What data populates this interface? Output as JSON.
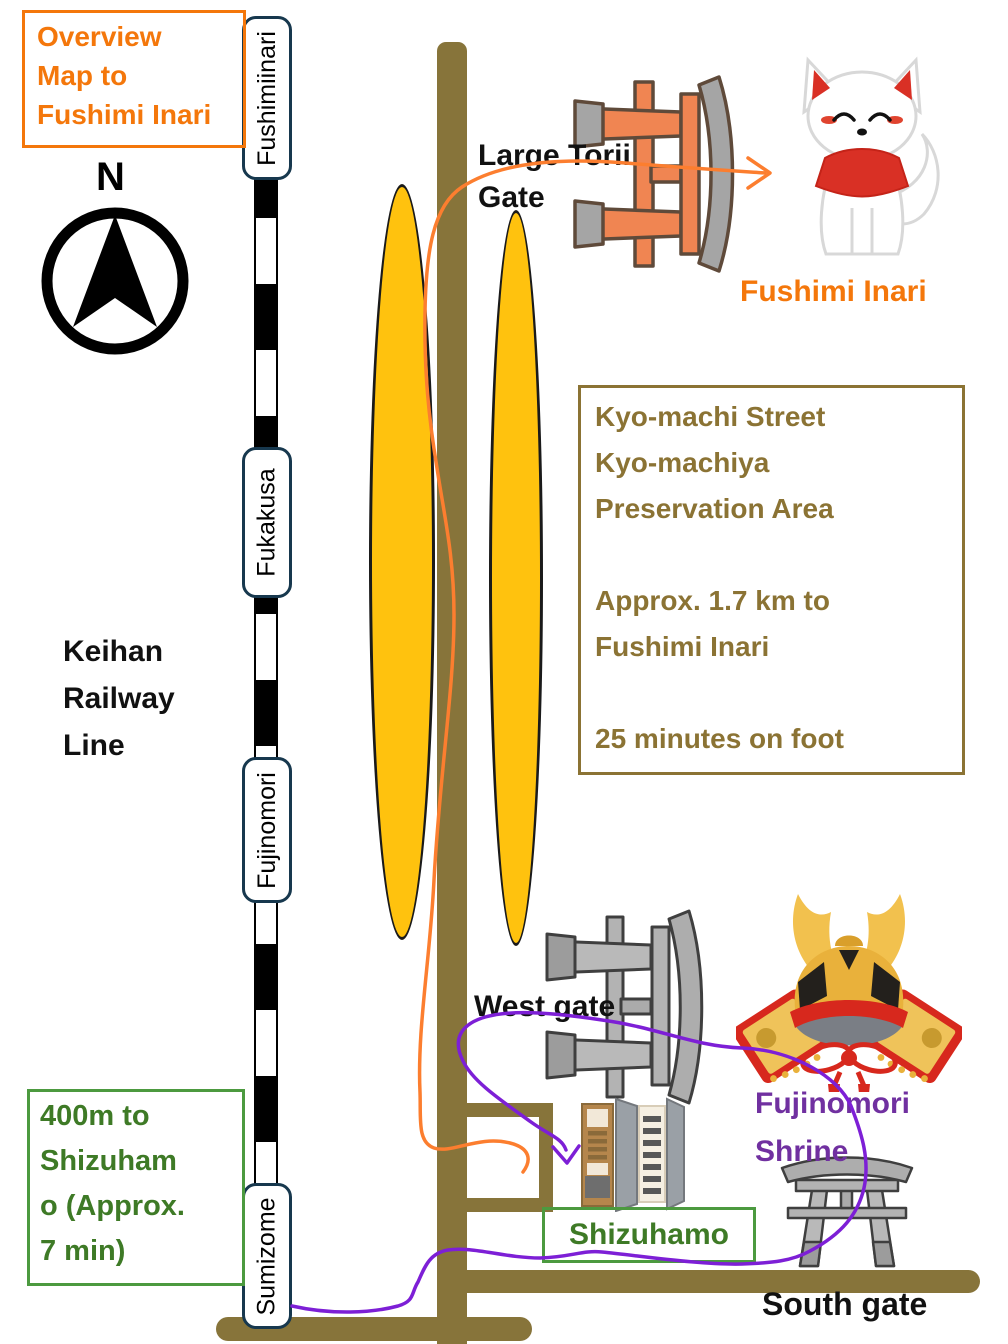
{
  "title_box": {
    "text": "Overview\nMap to\nFushimi Inari"
  },
  "compass": {
    "north_label": "N"
  },
  "railway": {
    "name": "Keihan\nRailway\nLine",
    "stations": [
      "Fushimiinari",
      "Fukakusa",
      "Fujinomori",
      "Sumizome"
    ]
  },
  "labels": {
    "large_torii": "Large Torii\nGate",
    "fushimi_inari": "Fushimi Inari",
    "west_gate": "West gate",
    "south_gate": "South gate",
    "fujinomori_shrine": "Fujinomori\nShrine",
    "shizuhamo": "Shizuhamo"
  },
  "info_box": {
    "text": "Kyo-machi Street\nKyo-machiya\nPreservation Area\n\nApprox. 1.7 km to\nFushimi Inari\n\n25 minutes on foot"
  },
  "distance_box": {
    "text": "400m to\nShizuham\no (Approx.\n7 min)"
  },
  "icons": {
    "compass": "compass-icon",
    "fox": "fox-icon",
    "large_torii": "torii-gate-icon",
    "west_gate": "sketch-torii-icon",
    "south_gate": "sketch-torii-icon",
    "helmet": "kabuto-helmet-icon",
    "shop": "machiya-building-icon"
  },
  "colors": {
    "orange": "#F4770B",
    "road": "#87743A",
    "brown": "#8B7334",
    "green-text": "#3E7A26",
    "green-border": "#4C9A3F",
    "purple": "#7030A0",
    "route-purple": "#7D1FD6",
    "route-orange": "#FC7E2F",
    "navy": "#17384E",
    "yellow": "#FFC20E",
    "torii-salmon": "#F08552",
    "torii-gray": "#A5A5A5"
  }
}
